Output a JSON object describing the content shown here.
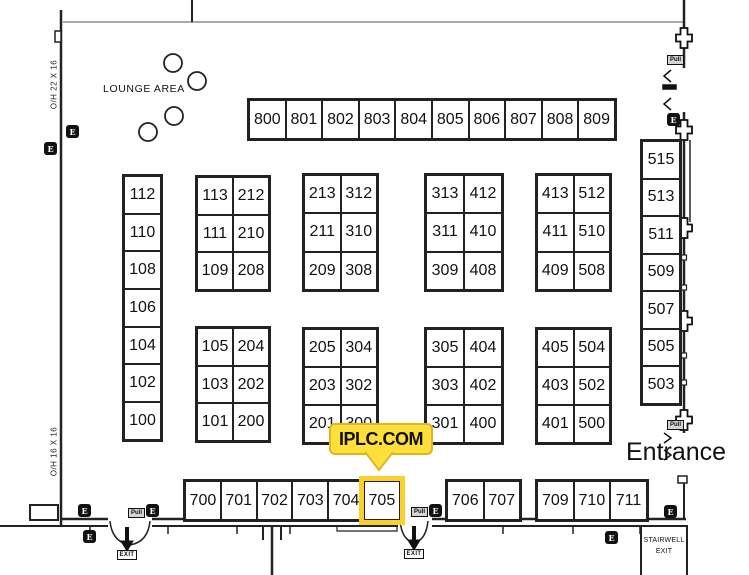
{
  "labels": {
    "lounge": "LOUNGE AREA",
    "entrance": "Entrance",
    "stairwell_line1": "STAIRWELL",
    "stairwell_line2": "EXIT",
    "oh_top": "O/H 22 X 16",
    "oh_bottom": "O/H 16 X 16"
  },
  "callout": {
    "label": "IPLC.COM",
    "target_booth": "705",
    "bg_color": "#ffdf3a",
    "border_color": "#e3b422"
  },
  "highlighted_booth": "705",
  "highlight_color": "#fcd02c",
  "booths": {
    "row_800": [
      "800",
      "801",
      "802",
      "803",
      "804",
      "805",
      "806",
      "807",
      "808",
      "809"
    ],
    "col_500": [
      "515",
      "513",
      "511",
      "509",
      "507",
      "505",
      "503"
    ],
    "col_100": [
      "112",
      "110",
      "108",
      "106",
      "104",
      "102",
      "100"
    ],
    "block_113_top": [
      "113",
      "212",
      "111",
      "210",
      "109",
      "208"
    ],
    "block_113_bottom": [
      "105",
      "204",
      "103",
      "202",
      "101",
      "200"
    ],
    "block_213_top": [
      "213",
      "312",
      "211",
      "310",
      "209",
      "308"
    ],
    "block_213_bottom": [
      "205",
      "304",
      "203",
      "302",
      "201",
      "300"
    ],
    "block_313_top": [
      "313",
      "412",
      "311",
      "410",
      "309",
      "408"
    ],
    "block_313_bottom": [
      "305",
      "404",
      "303",
      "402",
      "301",
      "400"
    ],
    "block_413_top": [
      "413",
      "512",
      "411",
      "510",
      "409",
      "508"
    ],
    "block_413_bottom": [
      "405",
      "504",
      "403",
      "502",
      "401",
      "500"
    ],
    "row_700_left": [
      "700",
      "701",
      "702",
      "703",
      "704",
      "705"
    ],
    "row_700_mid": [
      "706",
      "707"
    ],
    "row_700_right": [
      "709",
      "710",
      "711"
    ]
  },
  "icons": {
    "outlet_label": "E",
    "pull_label": "Pull",
    "exit_label": "EXIT"
  }
}
